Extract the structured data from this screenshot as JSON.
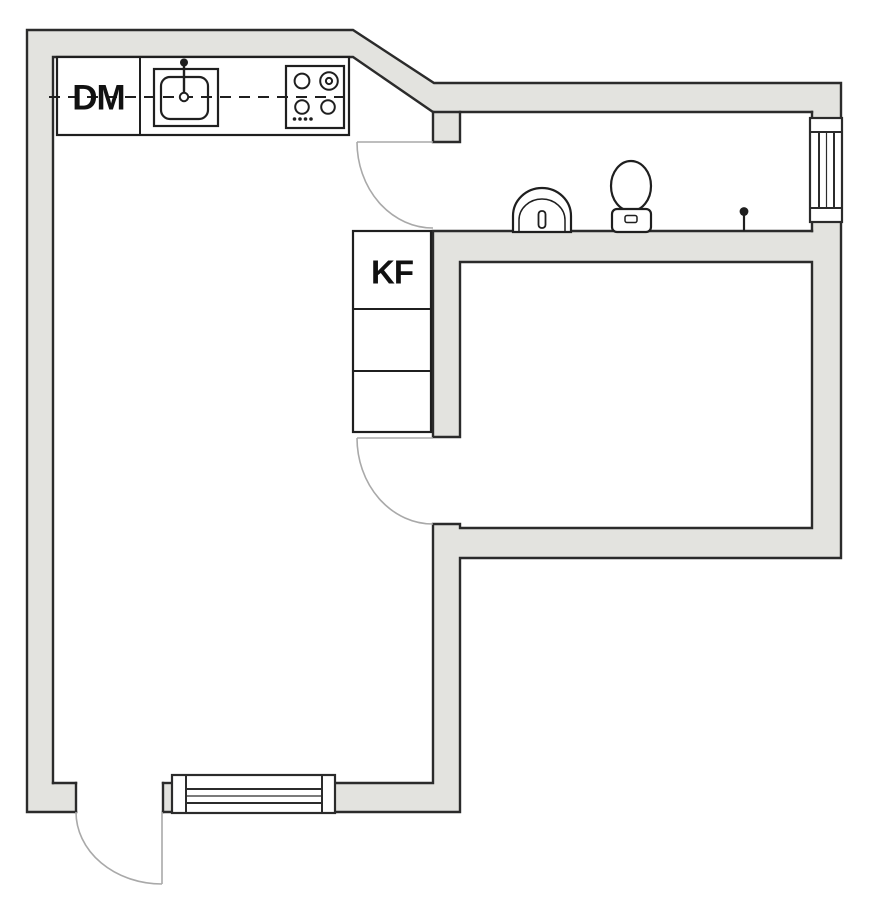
{
  "page": {
    "type": "apartment-floor-plan"
  },
  "labels": {
    "dishwasher": "DM",
    "fridge_freezer": "KF"
  },
  "colors": {
    "background": "#FFFFFF",
    "wall_fill": "#E3E3DF",
    "wall_outline": "#2B2B2B",
    "fixture_outline": "#1F1F1F",
    "door_swing": "#A9A9A9",
    "label_text": "#111111"
  },
  "fixtures": {
    "kitchen": [
      "dishwasher",
      "kitchen-sink",
      "stove"
    ],
    "bathroom": [
      "wash-basin",
      "toilet",
      "valve"
    ],
    "storage": [
      "fridge-freezer-cabinets"
    ],
    "openings": [
      "bathroom-door",
      "bedroom-door",
      "entrance-door",
      "bathroom-window",
      "living-room-window"
    ]
  }
}
